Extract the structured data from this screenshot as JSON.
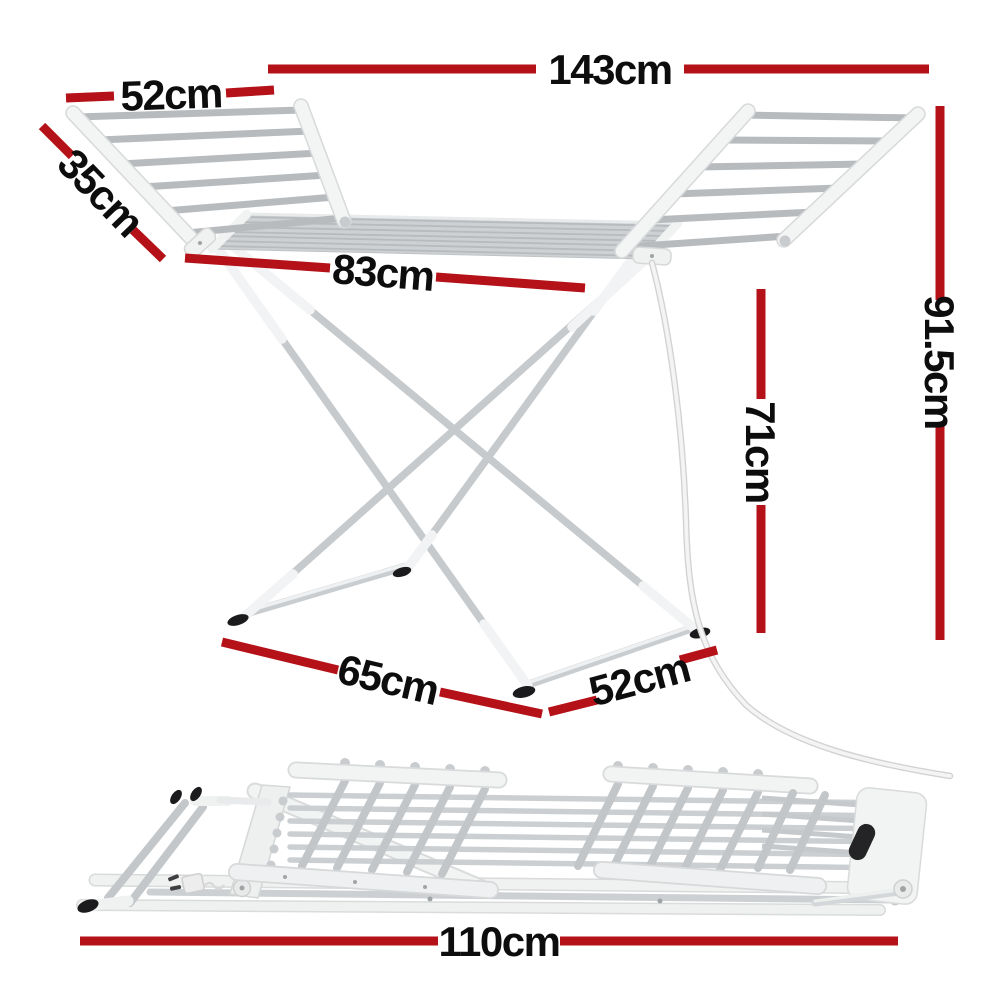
{
  "title": "Winged clothes airer dimension diagram",
  "colors": {
    "dimension_line_red": "#b51118",
    "dimension_text_black": "#0d0d0d",
    "frame_white": "#f3f4f4",
    "rod_gray": "#b7bbbe",
    "foot_black": "#1b1b1d",
    "background": "#ffffff"
  },
  "dimensions": {
    "standing_view": {
      "total_width": "143cm",
      "wing_width": "52cm",
      "wing_depth": "35cm",
      "center_section_width": "83cm",
      "overall_height": "91.5cm",
      "rail_height": "71cm",
      "base_length": "65cm",
      "base_width": "52cm"
    },
    "folded_view": {
      "folded_length": "110cm"
    }
  }
}
